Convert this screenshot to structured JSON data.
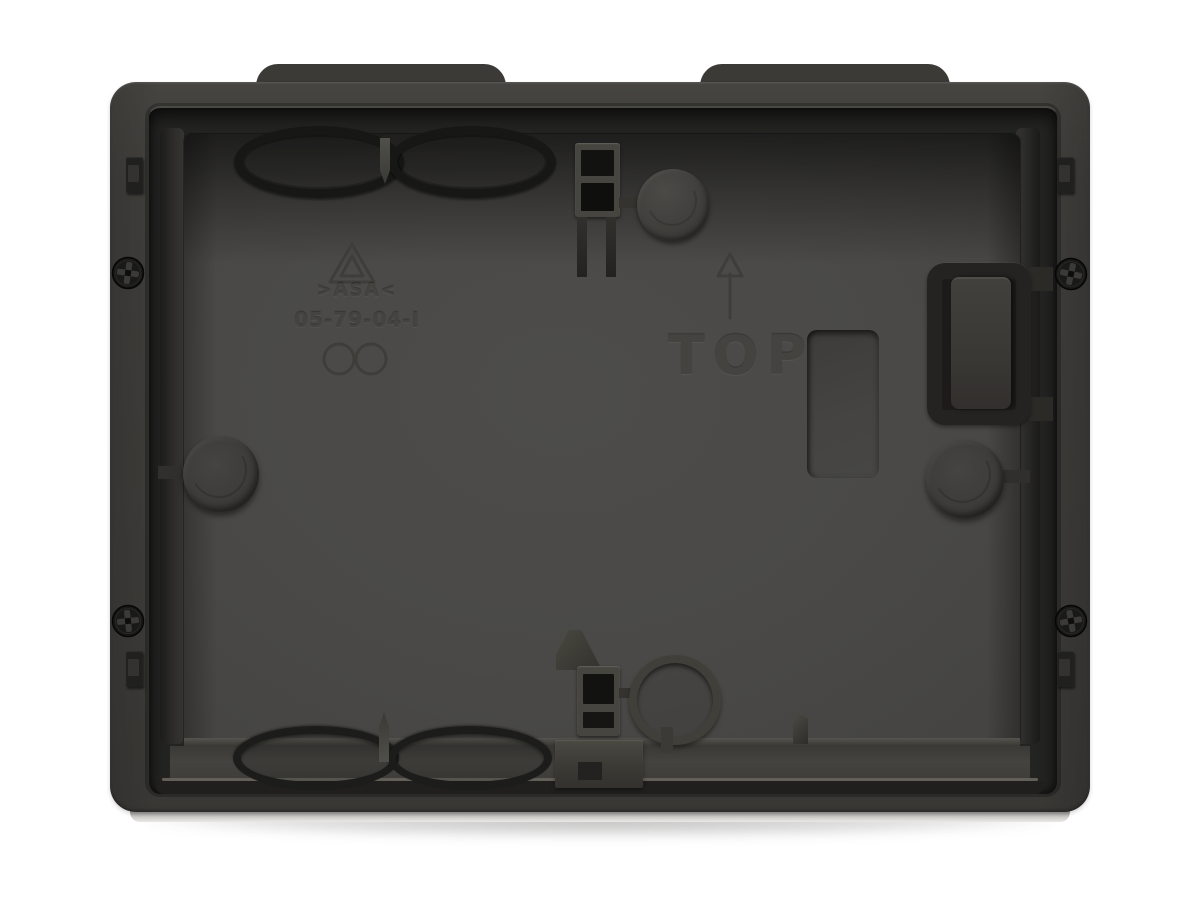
{
  "scene": {
    "subject": "Anthracite flush-mount installation box, interior front view",
    "background": "#ffffff"
  },
  "markings": {
    "material_code": ">ASA<",
    "mold_code": "05-79-04-I",
    "orientation_label": "TOP",
    "symbols": [
      "recycling-triangle",
      "mold-circles",
      "up-arrow"
    ]
  },
  "palette": {
    "background": "#ffffff",
    "frame": "#3f3e3b",
    "frame_top": "#454440",
    "frame_dark": "#343330",
    "cavity": "#232322",
    "plate": "#4a4947",
    "plate_dark": "#444341",
    "hardware_dark": "#1b1b1a",
    "ring_dark": "#171716",
    "rim_highlight": "#8f8d84"
  }
}
